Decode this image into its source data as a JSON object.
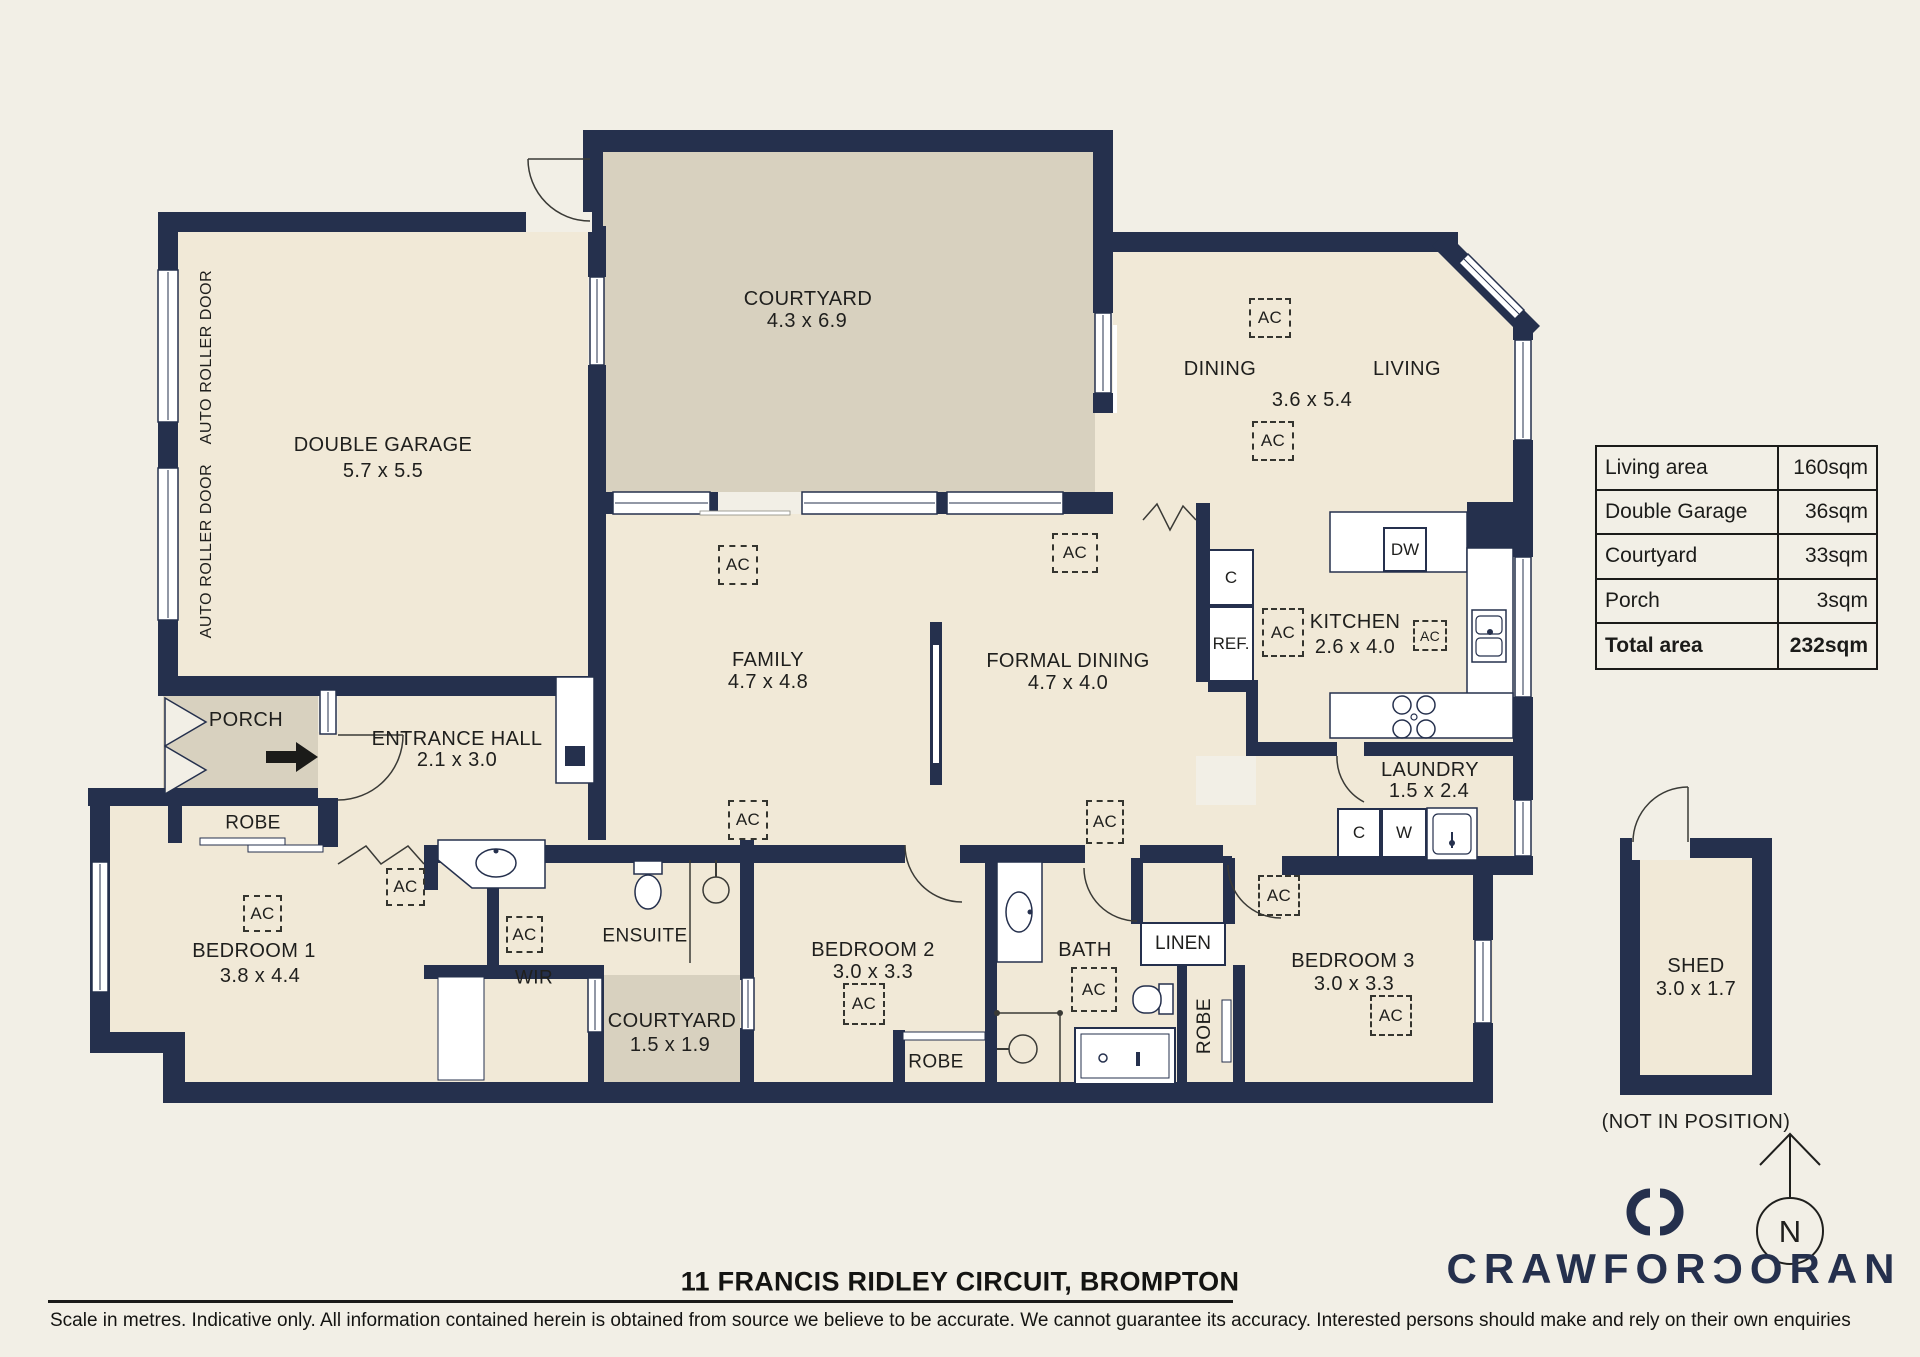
{
  "rooms": {
    "garage": {
      "name": "DOUBLE GARAGE",
      "dims": "5.7 x 5.5"
    },
    "courtyard": {
      "name": "COURTYARD",
      "dims": "4.3 x 6.9"
    },
    "dining": {
      "name": "DINING"
    },
    "living": {
      "name": "LIVING"
    },
    "dining_living": {
      "dims": "3.6 x 5.4"
    },
    "family": {
      "name": "FAMILY",
      "dims": "4.7 x 4.8"
    },
    "formal_dining": {
      "name": "FORMAL DINING",
      "dims": "4.7 x 4.0"
    },
    "kitchen": {
      "name": "KITCHEN",
      "dims": "2.6 x 4.0"
    },
    "laundry": {
      "name": "LAUNDRY",
      "dims": "1.5 x 2.4"
    },
    "entrance_hall": {
      "name": "ENTRANCE HALL",
      "dims": "2.1 x 3.0"
    },
    "porch": {
      "name": "PORCH"
    },
    "bedroom1": {
      "name": "BEDROOM 1",
      "dims": "3.8 x 4.4"
    },
    "robe_bedroom1": {
      "name": "ROBE"
    },
    "ensuite": {
      "name": "ENSUITE"
    },
    "wir": {
      "name": "WIR"
    },
    "courtyard_small": {
      "name": "COURTYARD",
      "dims": "1.5 x 1.9"
    },
    "bedroom2": {
      "name": "BEDROOM 2",
      "dims": "3.0 x 3.3"
    },
    "robe_bedroom2": {
      "name": "ROBE"
    },
    "bath": {
      "name": "BATH"
    },
    "linen": {
      "name": "LINEN"
    },
    "robe_bedroom3": {
      "name": "ROBE"
    },
    "bedroom3": {
      "name": "BEDROOM 3",
      "dims": "3.0 x 3.3"
    },
    "shed": {
      "name": "SHED",
      "dims": "3.0 x 1.7",
      "note": "(NOT IN POSITION)"
    }
  },
  "labels": {
    "ac": "AC",
    "auto_roller_door": "AUTO ROLLER DOOR",
    "dw": "DW",
    "ref": "REF.",
    "cupboard": "C",
    "washer": "W",
    "north": "N"
  },
  "area_table": {
    "rows": [
      {
        "label": "Living area",
        "value": "160sqm"
      },
      {
        "label": "Double Garage",
        "value": "36sqm"
      },
      {
        "label": "Courtyard",
        "value": "33sqm"
      },
      {
        "label": "Porch",
        "value": "3sqm"
      },
      {
        "label": "Total area",
        "value": "232sqm"
      }
    ]
  },
  "footer": {
    "address": "11 FRANCIS RIDLEY CIRCUIT, BROMPTON",
    "disclaimer": "Scale in metres. Indicative only. All information contained herein is obtained from source we believe to be accurate. We cannot guarantee its accuracy. Interested persons should make and rely on their own enquiries"
  },
  "brand": {
    "name": "CRAWFORDORAN",
    "display": "CRAWFORƆORAN"
  }
}
